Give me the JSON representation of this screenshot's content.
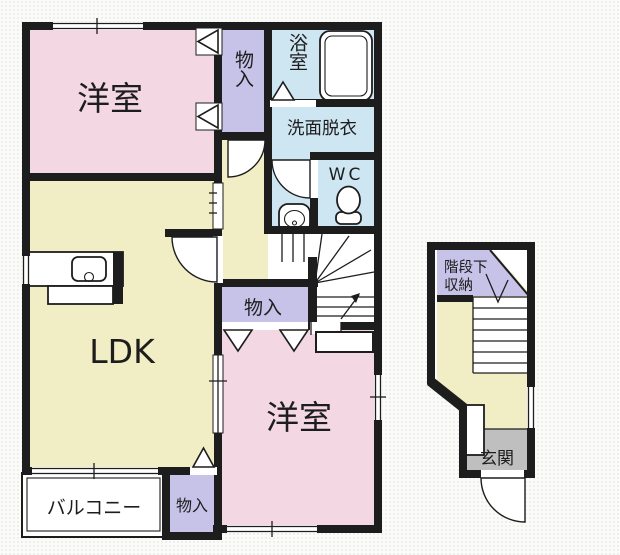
{
  "colors": {
    "wall": "#1d1d1d",
    "room_pink": "#f3d7e3",
    "room_yellow": "#f1edc4",
    "closet_lavender": "#c6c2e8",
    "bath_blue": "#cde6f2",
    "entrance_gray": "#bfbfbf",
    "floor_white": "#ffffff"
  },
  "floor2": {
    "rooms": {
      "bedroom1": {
        "label": "洋室"
      },
      "ldk": {
        "label": "LDK"
      },
      "bedroom2": {
        "label": "洋室"
      },
      "bathroom": {
        "label": "浴室"
      },
      "washroom": {
        "label": "洗面脱衣"
      },
      "toilet": {
        "label": "WC"
      },
      "closet_top": {
        "label": "物入"
      },
      "closet_mid": {
        "label": "物入"
      },
      "closet_bottom": {
        "label": "物入"
      },
      "balcony": {
        "label": "バルコニー"
      }
    }
  },
  "floor1": {
    "rooms": {
      "under_stairs_storage": {
        "label_line1": "階段下",
        "label_line2": "収納"
      },
      "entrance": {
        "label": "玄関"
      }
    }
  }
}
